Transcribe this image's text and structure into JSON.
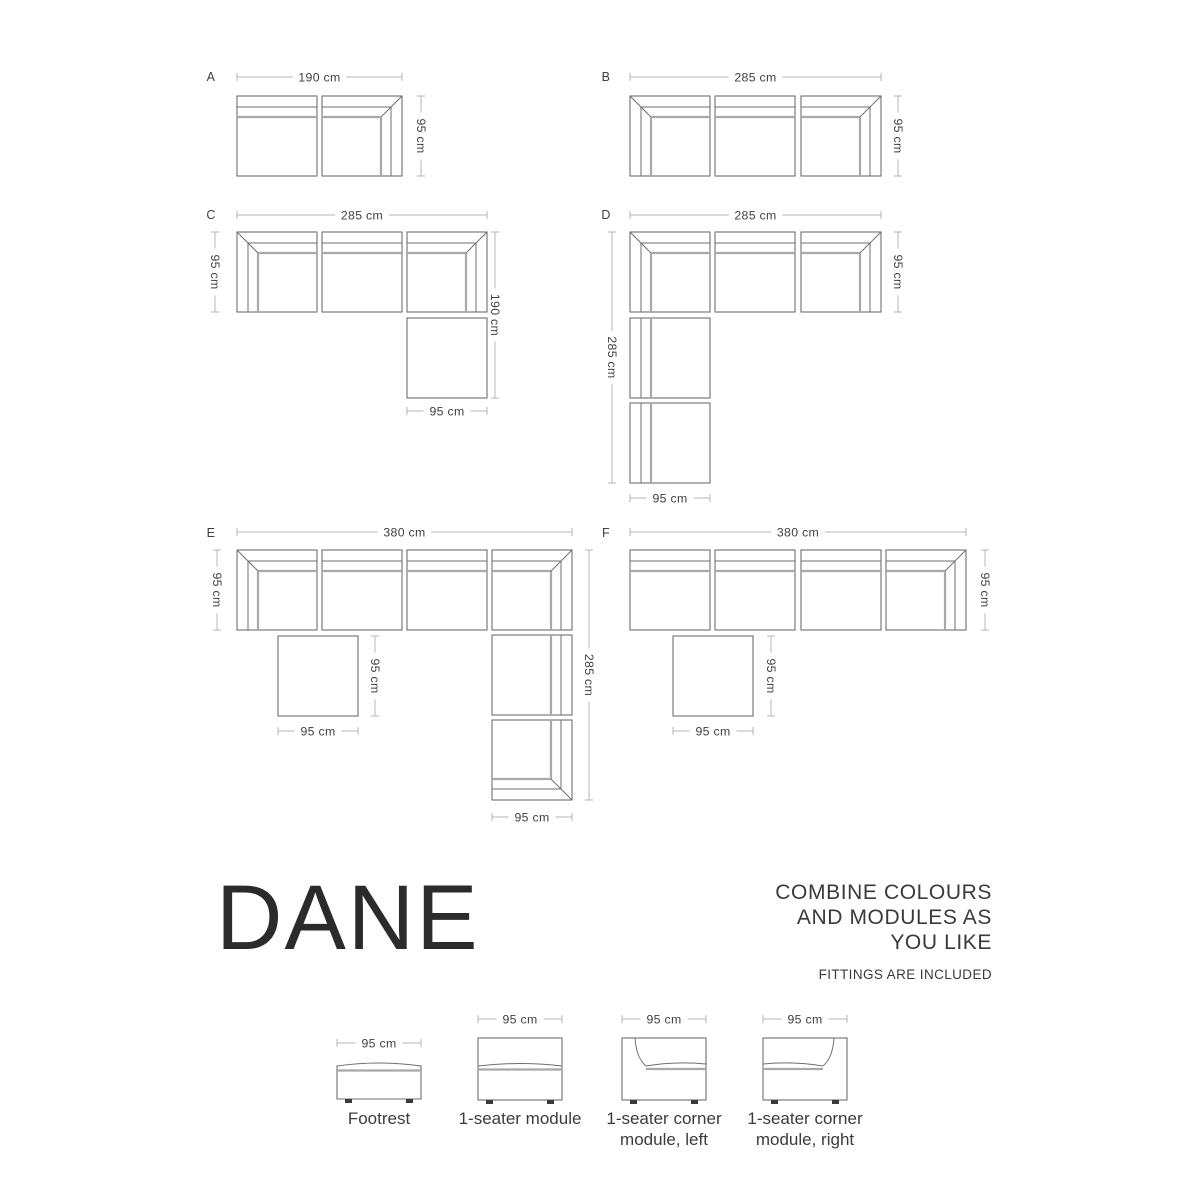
{
  "colors": {
    "background": "#ffffff",
    "outline": "#6f6f6f",
    "cushion_line": "#a8a8a8",
    "dimension_line": "#b6b6b6",
    "dimension_text": "#3f3f3f",
    "brand_text": "#2b2b2b",
    "feet": "#3a3a3a"
  },
  "branding": {
    "brand": "DANE",
    "tagline_line1": "COMBINE COLOURS",
    "tagline_line2": "AND MODULES AS",
    "tagline_line3": "YOU LIKE",
    "note": "FITTINGS ARE INCLUDED"
  },
  "diagram": {
    "module_size": 80,
    "configs": [
      {
        "label": "A",
        "lx": 211,
        "ly": 81,
        "modules": [
          [
            "seat",
            237,
            96
          ],
          [
            "corner-tr",
            322,
            96
          ]
        ],
        "dims": [
          {
            "o": "h",
            "t": "190 cm",
            "a": 237,
            "b": 402,
            "p": 77
          },
          {
            "o": "v",
            "t": "95 cm",
            "a": 96,
            "b": 176,
            "p": 421
          }
        ]
      },
      {
        "label": "B",
        "lx": 606,
        "ly": 81,
        "modules": [
          [
            "corner-tl",
            630,
            96
          ],
          [
            "seat",
            715,
            96
          ],
          [
            "corner-tr",
            801,
            96
          ]
        ],
        "dims": [
          {
            "o": "h",
            "t": "285 cm",
            "a": 630,
            "b": 881,
            "p": 77
          },
          {
            "o": "v",
            "t": "95 cm",
            "a": 96,
            "b": 176,
            "p": 898
          }
        ]
      },
      {
        "label": "C",
        "lx": 211,
        "ly": 219,
        "modules": [
          [
            "corner-tl",
            237,
            232
          ],
          [
            "seat",
            322,
            232
          ],
          [
            "corner-tr",
            407,
            232
          ],
          [
            "footrest-top",
            407,
            318
          ]
        ],
        "dims": [
          {
            "o": "h",
            "t": "285 cm",
            "a": 237,
            "b": 487,
            "p": 215
          },
          {
            "o": "v",
            "t": "95 cm",
            "a": 232,
            "b": 312,
            "p": 215
          },
          {
            "o": "v",
            "t": "190 cm",
            "a": 232,
            "b": 398,
            "p": 495
          },
          {
            "o": "h",
            "t": "95 cm",
            "a": 407,
            "b": 487,
            "p": 411
          }
        ]
      },
      {
        "label": "D",
        "lx": 606,
        "ly": 219,
        "modules": [
          [
            "corner-tl",
            630,
            232
          ],
          [
            "seat",
            715,
            232
          ],
          [
            "corner-tr",
            801,
            232
          ],
          [
            "side-left",
            630,
            318
          ],
          [
            "side-left",
            630,
            403
          ]
        ],
        "dims": [
          {
            "o": "h",
            "t": "285 cm",
            "a": 630,
            "b": 881,
            "p": 215
          },
          {
            "o": "v",
            "t": "285 cm",
            "a": 232,
            "b": 483,
            "p": 612
          },
          {
            "o": "v",
            "t": "95 cm",
            "a": 232,
            "b": 312,
            "p": 898
          },
          {
            "o": "h",
            "t": "95 cm",
            "a": 630,
            "b": 710,
            "p": 498
          }
        ]
      },
      {
        "label": "E",
        "lx": 211,
        "ly": 537,
        "modules": [
          [
            "corner-tl",
            237,
            550
          ],
          [
            "seat",
            322,
            550
          ],
          [
            "seat",
            407,
            550
          ],
          [
            "corner-tr",
            492,
            550
          ],
          [
            "footrest-top",
            278,
            636
          ],
          [
            "side-right",
            492,
            635
          ],
          [
            "corner-br",
            492,
            720
          ]
        ],
        "dims": [
          {
            "o": "h",
            "t": "380 cm",
            "a": 237,
            "b": 572,
            "p": 532
          },
          {
            "o": "v",
            "t": "95 cm",
            "a": 550,
            "b": 630,
            "p": 217
          },
          {
            "o": "v",
            "t": "95 cm",
            "a": 636,
            "b": 716,
            "p": 375
          },
          {
            "o": "h",
            "t": "95 cm",
            "a": 278,
            "b": 358,
            "p": 731
          },
          {
            "o": "v",
            "t": "285 cm",
            "a": 550,
            "b": 800,
            "p": 589
          },
          {
            "o": "h",
            "t": "95 cm",
            "a": 492,
            "b": 572,
            "p": 817
          }
        ]
      },
      {
        "label": "F",
        "lx": 606,
        "ly": 537,
        "modules": [
          [
            "seat",
            630,
            550
          ],
          [
            "seat",
            715,
            550
          ],
          [
            "seat",
            801,
            550
          ],
          [
            "corner-tr",
            886,
            550
          ],
          [
            "footrest-top",
            673,
            636
          ]
        ],
        "dims": [
          {
            "o": "h",
            "t": "380 cm",
            "a": 630,
            "b": 966,
            "p": 532
          },
          {
            "o": "v",
            "t": "95 cm",
            "a": 550,
            "b": 630,
            "p": 985
          },
          {
            "o": "v",
            "t": "95 cm",
            "a": 636,
            "b": 716,
            "p": 771
          },
          {
            "o": "h",
            "t": "95 cm",
            "a": 673,
            "b": 753,
            "p": 731
          }
        ]
      }
    ]
  },
  "catalog": {
    "items": [
      {
        "label": "Footrest",
        "kind": "footrest",
        "box": [
          337,
          1066,
          84,
          33
        ],
        "dim": {
          "o": "h",
          "t": "95 cm",
          "a": 337,
          "b": 421,
          "p": 1043
        },
        "label_cx": 379
      },
      {
        "label": "1-seater module",
        "kind": "seat",
        "box": [
          478,
          1038,
          84,
          62
        ],
        "dim": {
          "o": "h",
          "t": "95 cm",
          "a": 478,
          "b": 562,
          "p": 1019
        },
        "label_cx": 520
      },
      {
        "label": "1-seater corner module, left",
        "kind": "corner-left",
        "box": [
          622,
          1038,
          84,
          62
        ],
        "dim": {
          "o": "h",
          "t": "95 cm",
          "a": 622,
          "b": 706,
          "p": 1019
        },
        "label_cx": 664
      },
      {
        "label": "1-seater corner module, right",
        "kind": "corner-right",
        "box": [
          763,
          1038,
          84,
          62
        ],
        "dim": {
          "o": "h",
          "t": "95 cm",
          "a": 763,
          "b": 847,
          "p": 1019
        },
        "label_cx": 805
      }
    ]
  }
}
